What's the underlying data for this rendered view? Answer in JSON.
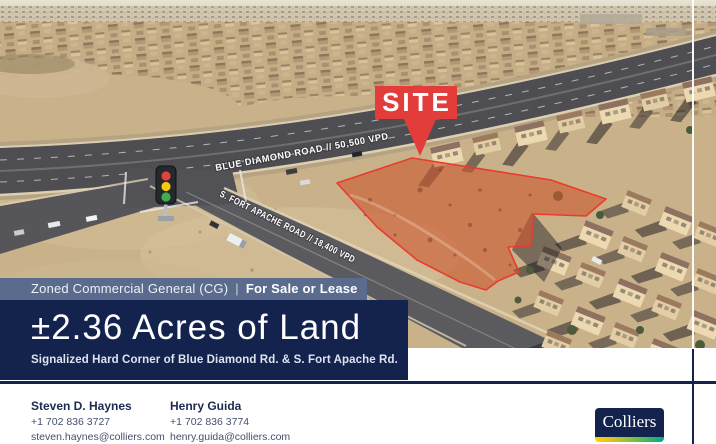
{
  "photo": {
    "site_label": "SITE",
    "road_label_blue_diamond": "BLUE DIAMOND ROAD // 50,500 VPD",
    "road_label_fort_apache": "S. FORT APACHE ROAD // 18,400 VPD"
  },
  "zoning": {
    "zoned_text": "Zoned Commercial General (CG)",
    "separator": "|",
    "sale_text": "For Sale or Lease"
  },
  "banner": {
    "headline": "±2.36 Acres of Land",
    "subheadline": "Signalized Hard Corner of Blue Diamond Rd. & S. Fort Apache Rd."
  },
  "agents": [
    {
      "name": "Steven D. Haynes",
      "phone": "+1 702 836 3727",
      "email": "steven.haynes@colliers.com"
    },
    {
      "name": "Henry Guida",
      "phone": "+1 702 836 3774",
      "email": "henry.guida@colliers.com"
    }
  ],
  "brand": {
    "logo_text": "Colliers"
  },
  "colors": {
    "navy": "#14224e",
    "steel_blue": "#5a6b8d",
    "site_red": "#e23d3b",
    "parcel_red": "#ea3b30",
    "logo_gradient": [
      "#ffd100",
      "#7ac143",
      "#00a88e"
    ]
  }
}
